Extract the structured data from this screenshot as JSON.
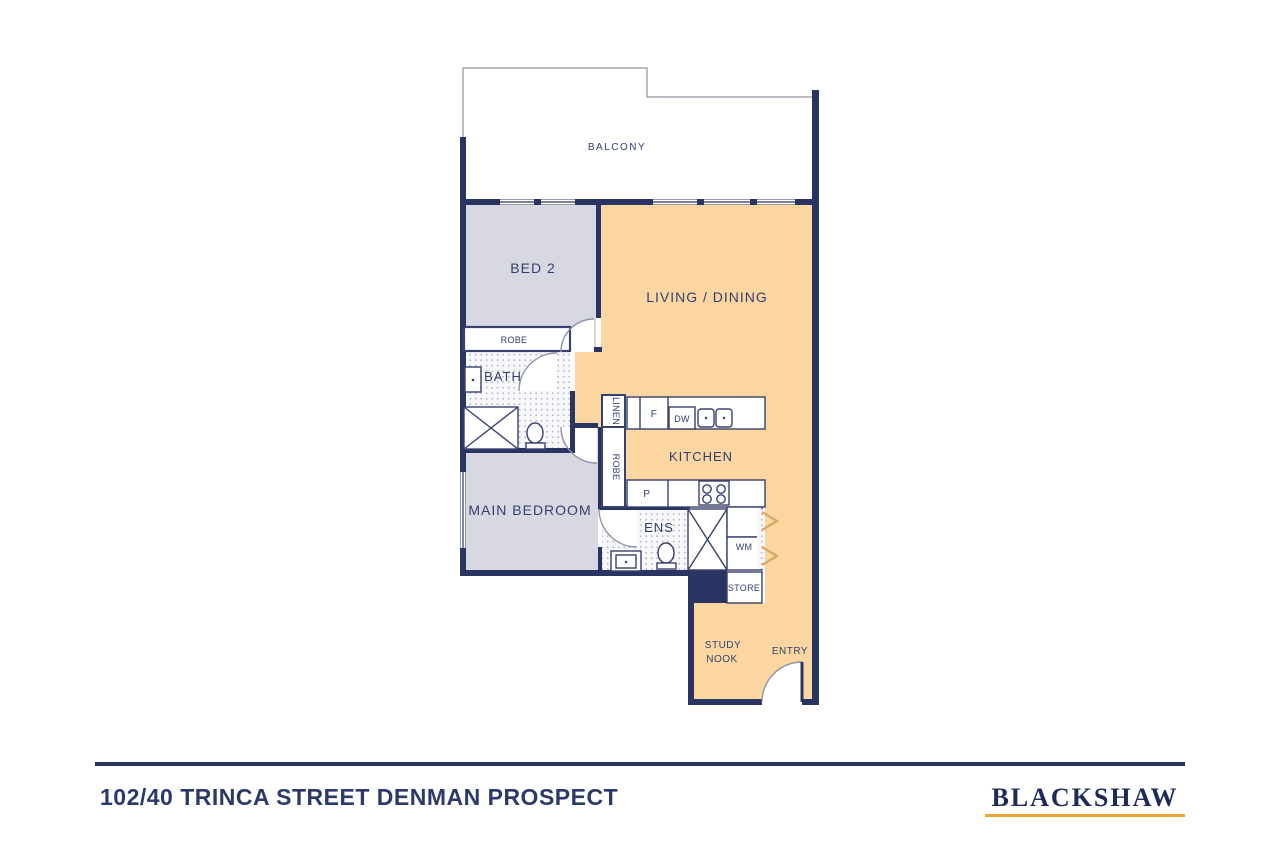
{
  "floorplan": {
    "labels": {
      "balcony": "BALCONY",
      "bed2": "BED 2",
      "living_dining": "LIVING / DINING",
      "robe_bed2": "ROBE",
      "bath": "BATH",
      "linen": "LINEN",
      "fridge": "F",
      "dishwasher": "DW",
      "kitchen": "KITCHEN",
      "robe_main": "ROBE",
      "pantry": "P",
      "main_bedroom": "MAIN BEDROOM",
      "ensuite": "ENS",
      "washing_machine": "WM",
      "store": "STORE",
      "study_nook_line1": "STUDY",
      "study_nook_line2": "NOOK",
      "entry": "ENTRY"
    },
    "colors": {
      "wall_navy": "#2a3463",
      "room_lavender": "#d8d8e3",
      "room_peach": "#fcd6a1",
      "tile_dot": "#b5b5c8",
      "balcony_outline": "#a6a6b0",
      "door_arc": "#8f93aa",
      "chevron_tan": "#d9a967",
      "logo_gold": "#eca735"
    }
  },
  "footer": {
    "address": "102/40 TRINCA STREET DENMAN PROSPECT",
    "brand": "BLACKSHAW"
  }
}
